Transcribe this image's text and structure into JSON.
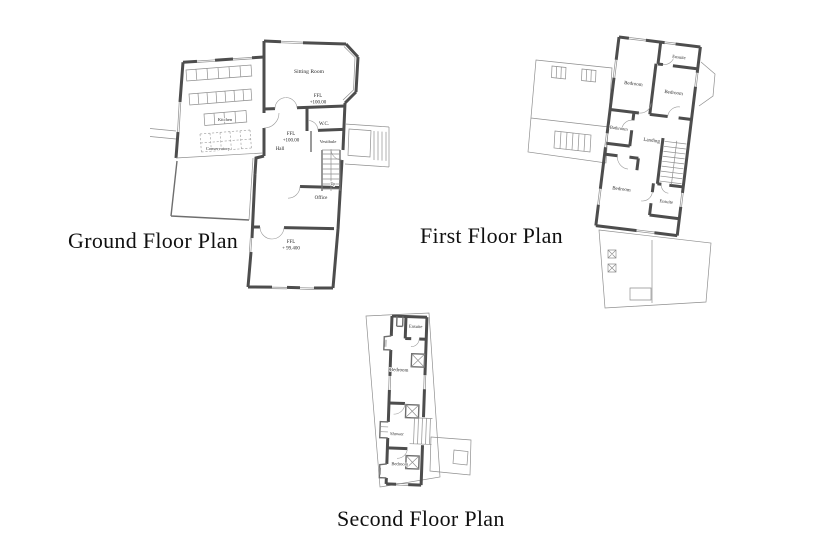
{
  "page": {
    "background": "#ffffff"
  },
  "titles": {
    "ground": "Ground Floor Plan",
    "first": "First Floor Plan",
    "second": "Second Floor Plan"
  },
  "ground_floor": {
    "sitting_room": "Sitting Room",
    "sitting_ffl_line1": "FFL",
    "sitting_ffl_line2": "+100.00",
    "wc": "W.C.",
    "hall_ffl_line1": "FFL",
    "hall_ffl_line2": "+100.00",
    "hall": "Hall",
    "vestibule": "Vestibule",
    "up": "Up",
    "office": "Office",
    "lower_ffl_line1": "FFL",
    "lower_ffl_line2": "+ 99.400",
    "kitchen": "Kitchen",
    "conservatory": "Conservatory"
  },
  "first_floor": {
    "bedroom_front": "Bedroom",
    "ensuite_front": "Ensuite",
    "bedroom_side": "Bedroom",
    "landing": "Landing",
    "bathroom": "Bathroom",
    "bedroom_rear": "Bedroom",
    "ensuite_rear": "Ensuite"
  },
  "second_floor": {
    "ensuite": "Ensuite",
    "bedroom_front": "Bedroom",
    "shower": "Shower",
    "bedroom_rear": "Bedroom"
  },
  "colors": {
    "wall": "#4d4d4d",
    "thin_line": "#8f8f8f",
    "text": "#2a2a2a",
    "title_text": "#101010",
    "background": "#ffffff"
  }
}
